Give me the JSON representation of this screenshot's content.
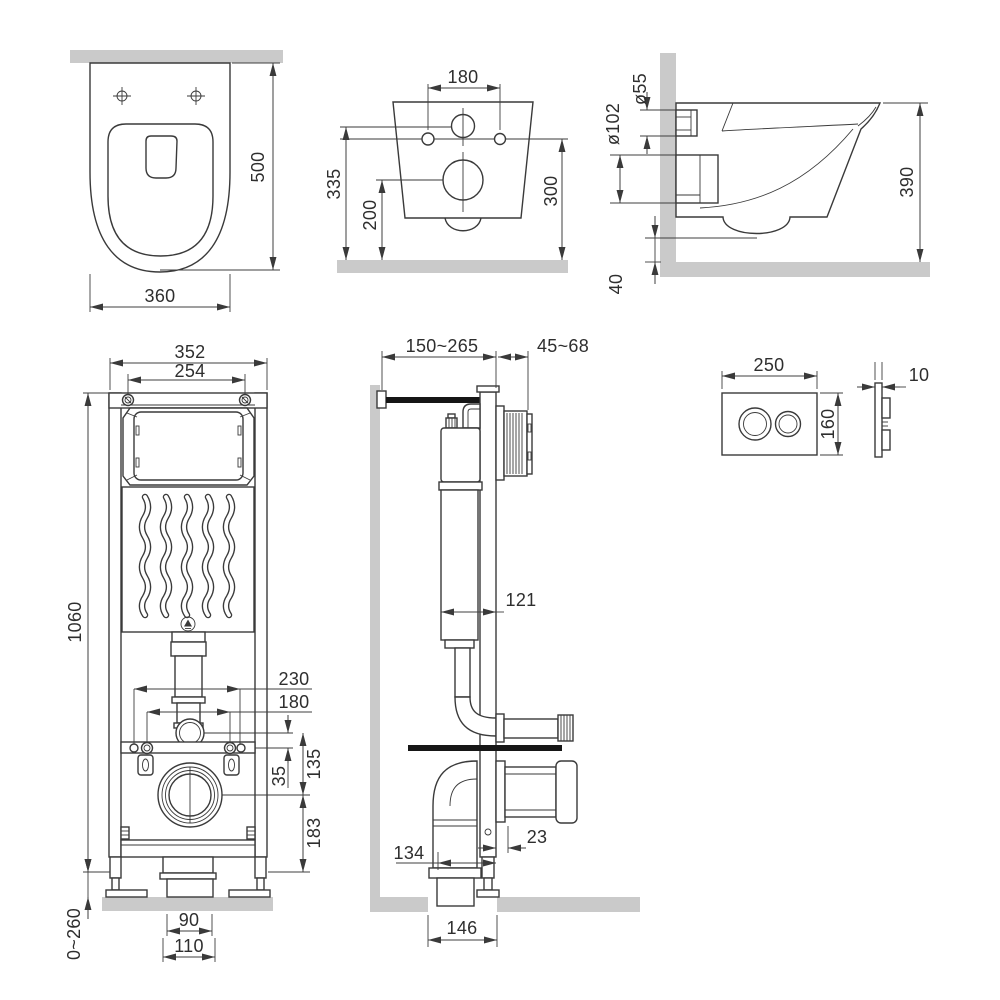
{
  "title": "Wall-hung toilet and installation frame dimensional drawing",
  "colors": {
    "line": "#3a3a3a",
    "gray_fill": "#cacaca",
    "black_fill": "#161616",
    "text": "#2e2e2e",
    "background": "#ffffff"
  },
  "views": {
    "toilet_top": {
      "label": "toilet-top-view",
      "depth": "500",
      "width": "360"
    },
    "toilet_rear": {
      "label": "toilet-rear-view",
      "bolt_spacing": "180",
      "inlet_height": "335",
      "drain_height": "200",
      "bolt_height": "300"
    },
    "toilet_side": {
      "label": "toilet-side-view",
      "inlet_dia": "ø55",
      "outlet_dia": "ø102",
      "height": "390",
      "clearance": "40"
    },
    "frame_front": {
      "label": "frame-front-view",
      "outer_width": "352",
      "inner_width": "254",
      "height": "1060",
      "stud_span_outer": "230",
      "stud_span_inner": "180",
      "bend_to_studs": "35",
      "bend_to_drain": "135",
      "drain_height": "183",
      "pipe_width": "90",
      "flange_width": "110",
      "foot_range": "0~260"
    },
    "frame_side": {
      "label": "frame-side-view",
      "depth_range": "150~265",
      "finish_range": "45~68",
      "tank_depth": "121",
      "drain_offset": "23",
      "bend_depth": "134",
      "floor_offset": "146"
    },
    "flush_plate": {
      "label": "flush-plate-view",
      "width": "250",
      "height": "160",
      "thickness": "10"
    }
  }
}
